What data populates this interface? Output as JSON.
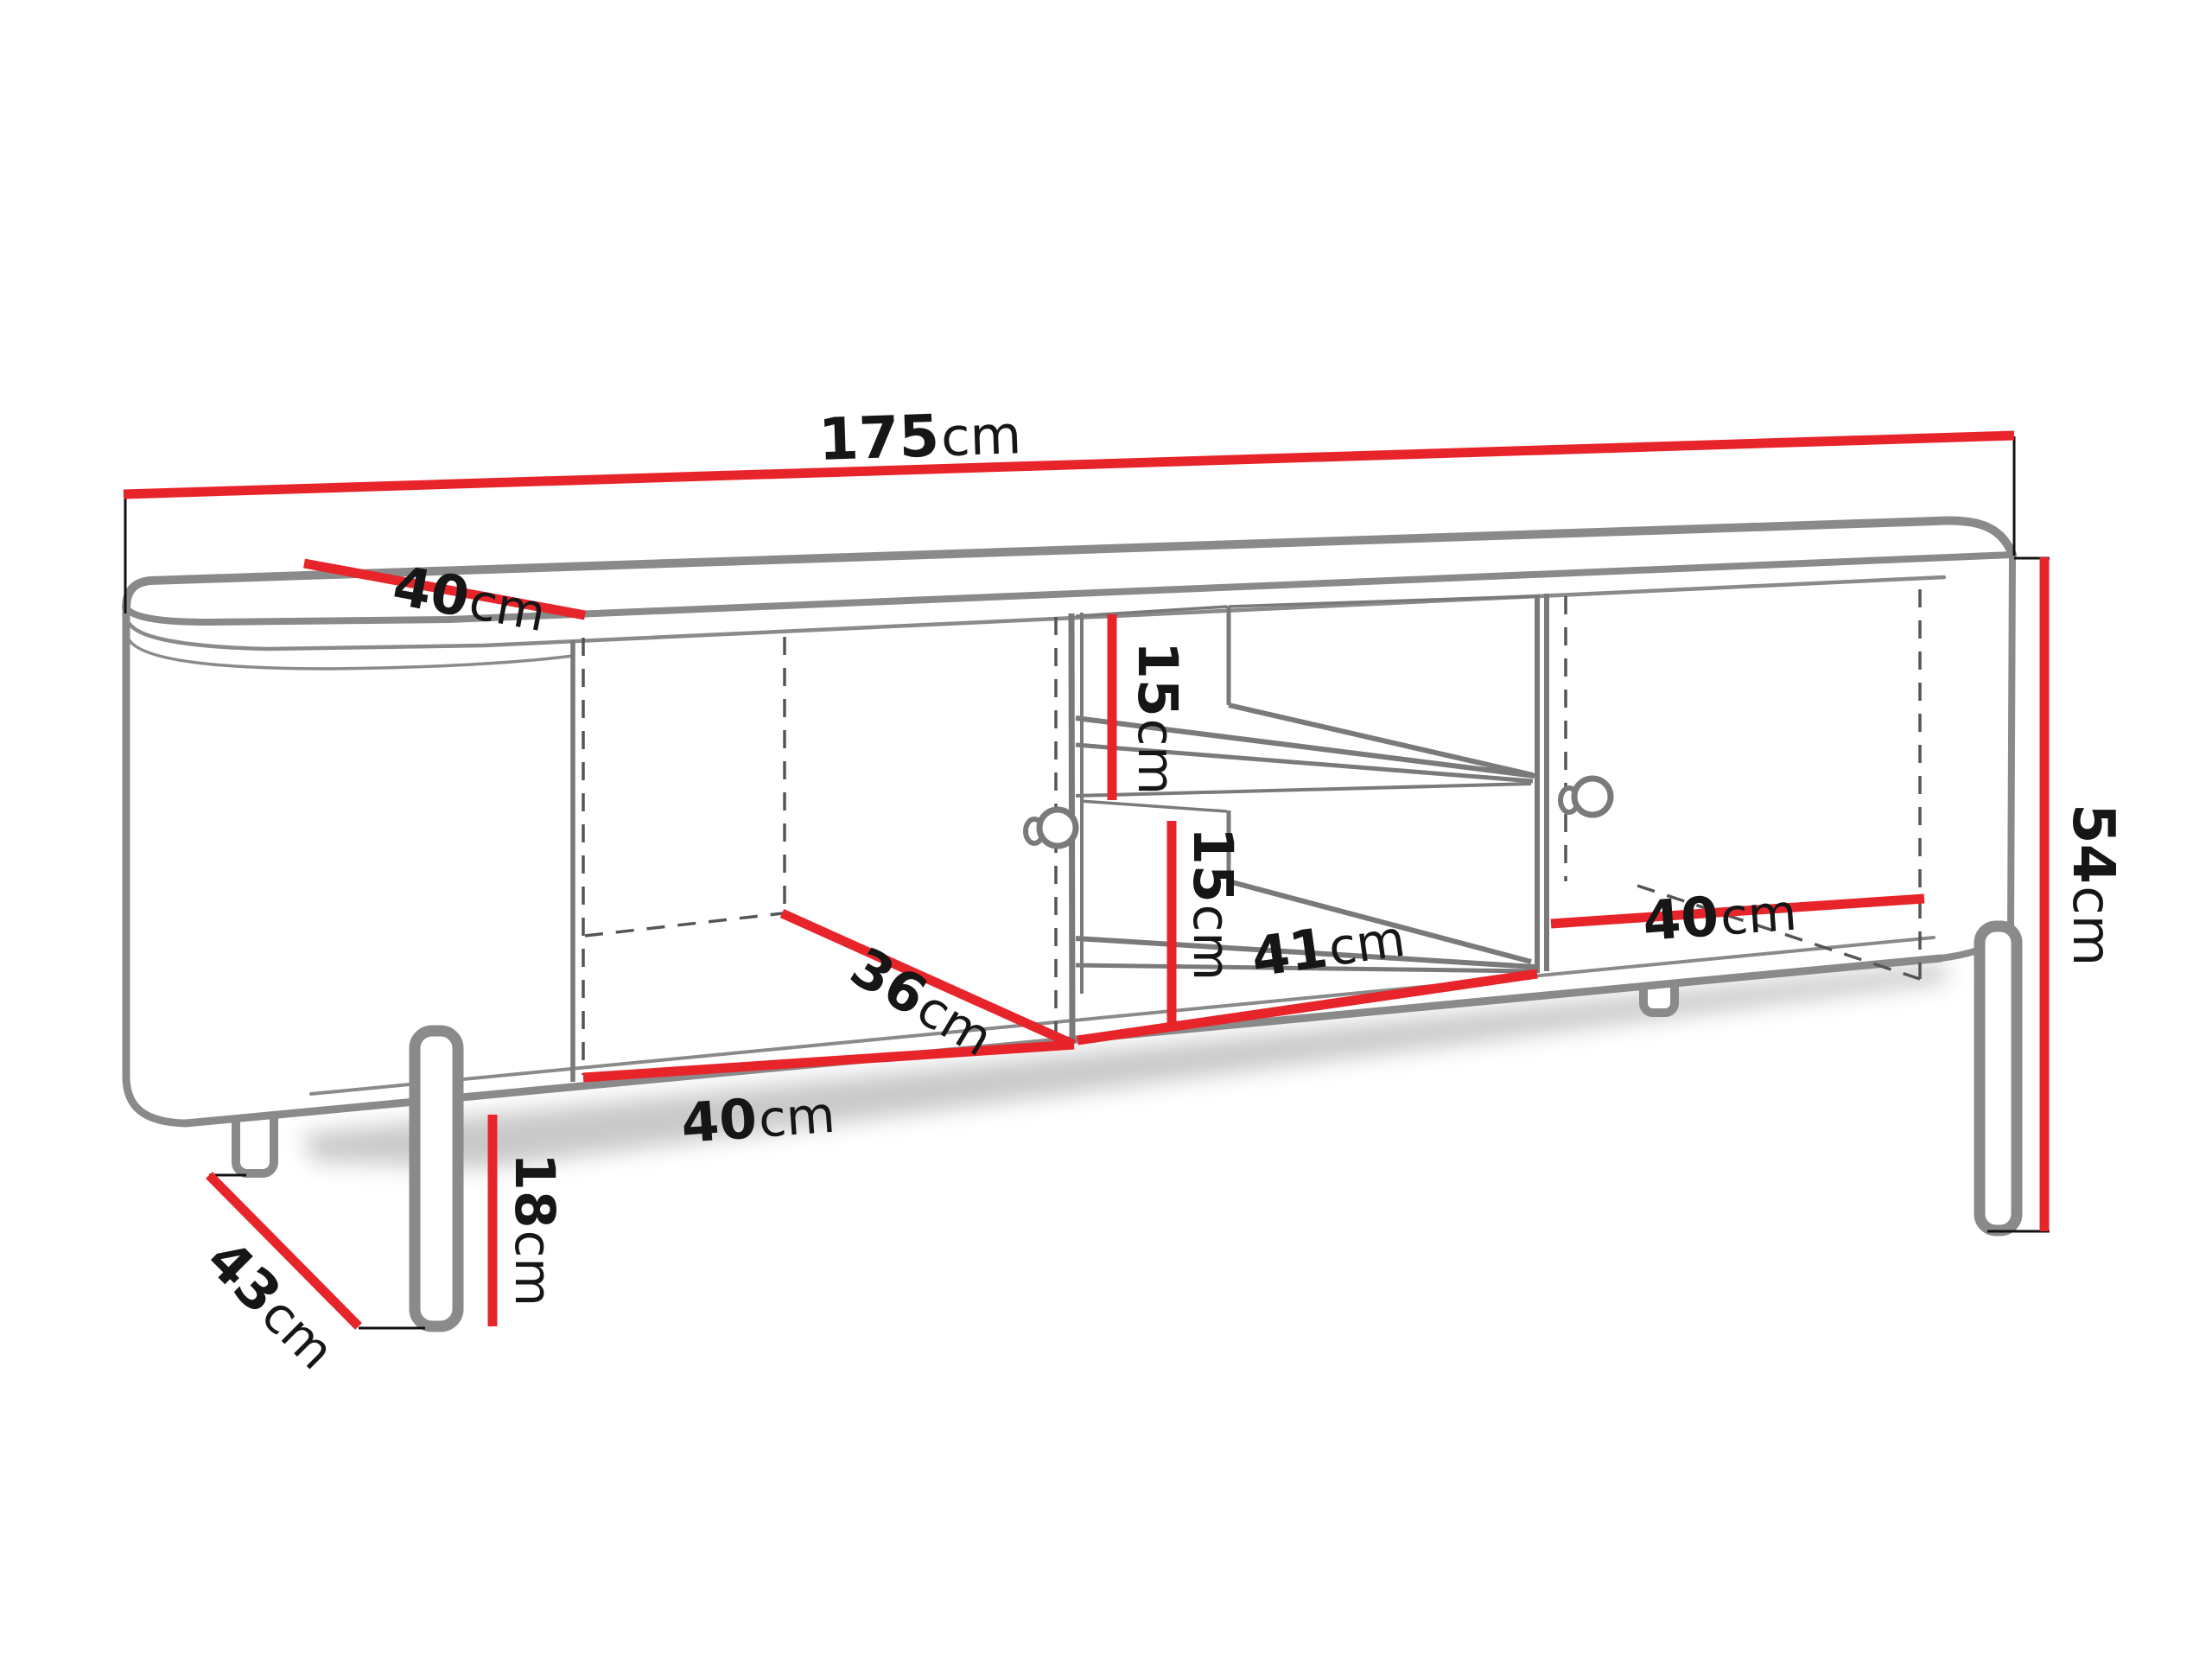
{
  "figure": {
    "kind": "furniture-dimension-diagram",
    "units": "cm"
  },
  "colors": {
    "dimension_line": "#e8242b",
    "outline_gray": "#8a8a8a",
    "interior_gray": "#7a7a7a",
    "tick_black": "#111111",
    "text": "#161616",
    "background": "#ffffff"
  },
  "dimensions": {
    "total_width": {
      "value": "175",
      "unit": "cm"
    },
    "top_depth": {
      "value": "40",
      "unit": "cm"
    },
    "total_height": {
      "value": "54",
      "unit": "cm"
    },
    "upper_shelf_height": {
      "value": "15",
      "unit": "cm"
    },
    "lower_shelf_height": {
      "value": "15",
      "unit": "cm"
    },
    "middle_inner_width": {
      "value": "41",
      "unit": "cm"
    },
    "left_inner_depth": {
      "value": "36",
      "unit": "cm"
    },
    "left_inner_width": {
      "value": "40",
      "unit": "cm"
    },
    "right_inner_width": {
      "value": "40",
      "unit": "cm"
    },
    "leg_height": {
      "value": "18",
      "unit": "cm"
    },
    "leg_span_depth": {
      "value": "43",
      "unit": "cm"
    }
  }
}
